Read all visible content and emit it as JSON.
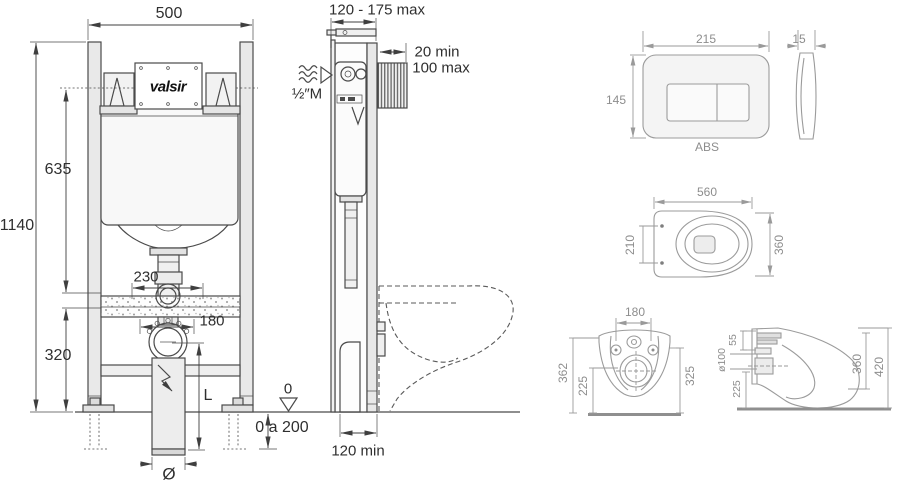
{
  "brand": {
    "logo_text": "valsir"
  },
  "frame_front": {
    "width": "500",
    "total_height": "1140",
    "upper_height": "635",
    "lower_height": "320",
    "inlet_spacing": "230",
    "outlet_spacing": "180",
    "pipe_length_label": "L",
    "datum_label": "0",
    "floor_offset_range": "0 a 200",
    "pipe_diameter_label": "Ø"
  },
  "frame_side": {
    "depth_range": "120 - 175 max",
    "wall_clearance_min": "20 min",
    "wall_clearance_max": "100 max",
    "water_inlet_thread": "½″M",
    "base_depth_min": "120 min"
  },
  "flush_plate": {
    "width": "215",
    "height": "145",
    "thickness": "15",
    "material": "ABS"
  },
  "wc_top_view": {
    "length": "560",
    "width": "360",
    "fixing_spacing": "210"
  },
  "wc_front_view": {
    "fixing_spacing": "180",
    "overall_height": "362",
    "drain_axis_height": "225",
    "bowl_height": "325"
  },
  "wc_side_view": {
    "inlet_offset": "55",
    "drain_diameter": "ø100",
    "drain_axis_height": "225",
    "inner_depth": "360",
    "overall_depth": "420"
  }
}
